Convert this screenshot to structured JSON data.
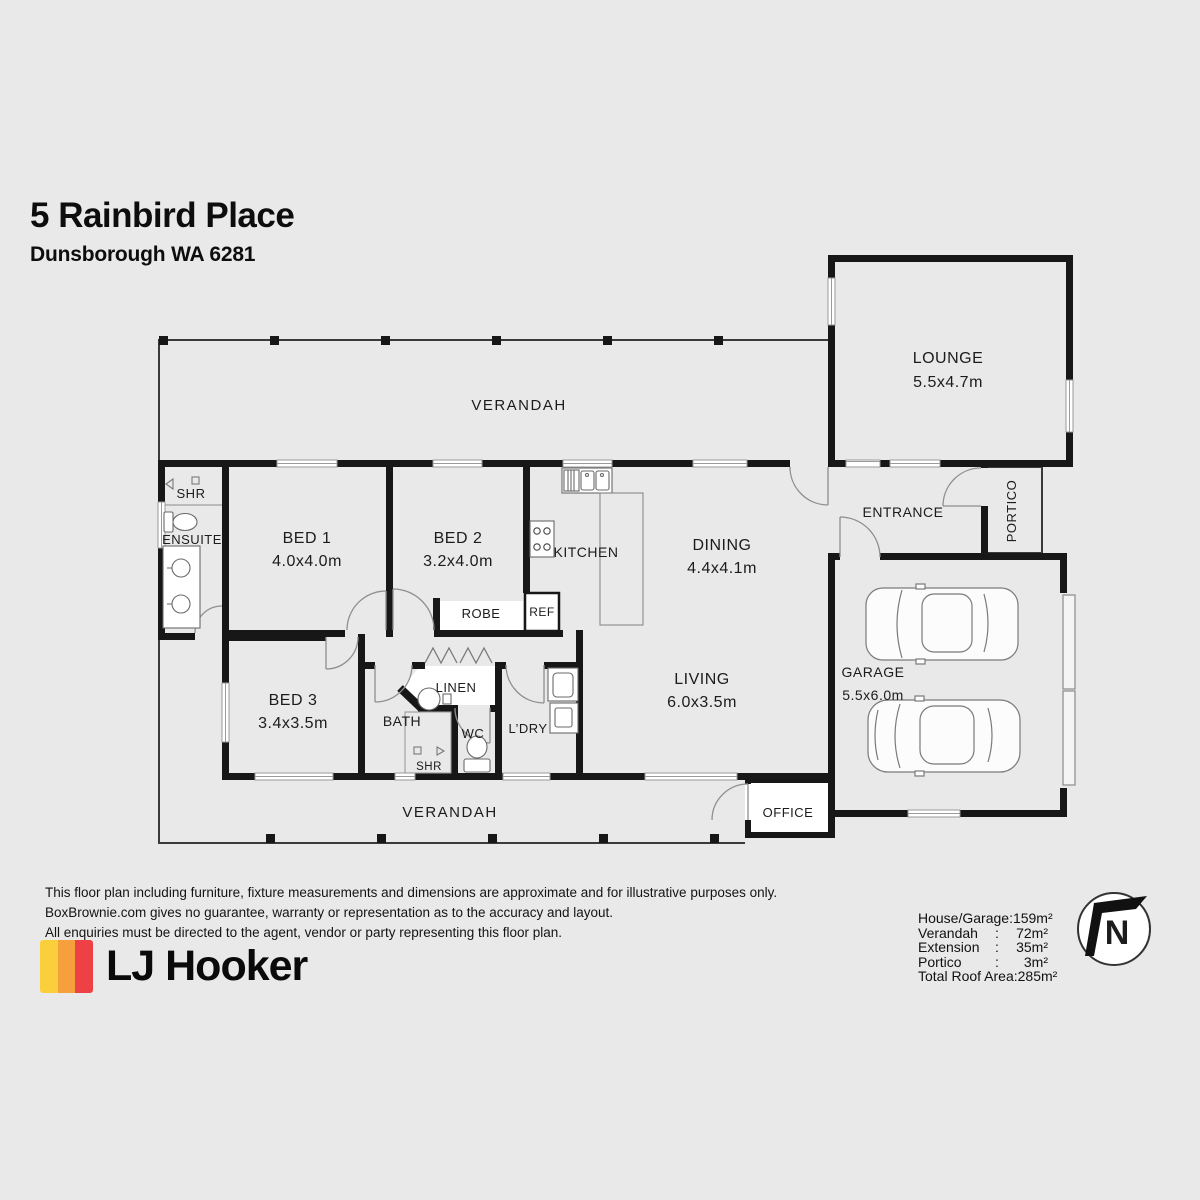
{
  "header": {
    "title": "5 Rainbird Place",
    "subtitle": "Dunsborough WA 6281"
  },
  "plan": {
    "rooms": {
      "verandah_top": {
        "label": "VERANDAH"
      },
      "lounge": {
        "label": "LOUNGE",
        "dims": "5.5x4.7m"
      },
      "ensuite_shr": {
        "label": "SHR"
      },
      "ensuite": {
        "label": "ENSUITE"
      },
      "bed1": {
        "label": "BED 1",
        "dims": "4.0x4.0m"
      },
      "bed2": {
        "label": "BED 2",
        "dims": "3.2x4.0m"
      },
      "kitchen": {
        "label": "KITCHEN"
      },
      "dining": {
        "label": "DINING",
        "dims": "4.4x4.1m"
      },
      "entrance": {
        "label": "ENTRANCE"
      },
      "portico": {
        "label": "PORTICO"
      },
      "robe": {
        "label": "ROBE"
      },
      "ref": {
        "label": "REF"
      },
      "bed3": {
        "label": "BED 3",
        "dims": "3.4x3.5m"
      },
      "bath": {
        "label": "BATH"
      },
      "linen": {
        "label": "LINEN"
      },
      "wc": {
        "label": "WC"
      },
      "bath_shr": {
        "label": "SHR"
      },
      "laundry": {
        "label": "L’DRY"
      },
      "living": {
        "label": "LIVING",
        "dims": "6.0x3.5m"
      },
      "garage": {
        "label": "GARAGE",
        "dims": "5.5x6.0m"
      },
      "verandah_bottom": {
        "label": "VERANDAH"
      },
      "office": {
        "label": "OFFICE"
      }
    },
    "north": {
      "label": "N"
    }
  },
  "footer": {
    "disclaimer": {
      "line1": "This floor plan including furniture, fixture measurements and dimensions are approximate and for illustrative purposes only.",
      "line2": "BoxBrownie.com gives no guarantee, warranty or representation as to the accuracy and layout.",
      "line3": "All enquiries must be directed to the agent, vendor or party representing this floor plan."
    },
    "logo": {
      "name": "LJ Hooker"
    },
    "areas": {
      "separator": ":",
      "rows": [
        {
          "label": "House/Garage",
          "value": "159m²"
        },
        {
          "label": "Verandah",
          "value": "72m²"
        },
        {
          "label": "Extension",
          "value": "35m²"
        },
        {
          "label": "Portico",
          "value": "3m²"
        },
        {
          "label": "Total Roof Area",
          "value": "285m²"
        }
      ]
    }
  },
  "colors": {
    "background": "#e9e9e9",
    "wall": "#171717",
    "logo_yellow": "#FBCF3B",
    "logo_orange": "#F5A03D",
    "logo_red": "#EE4145"
  }
}
